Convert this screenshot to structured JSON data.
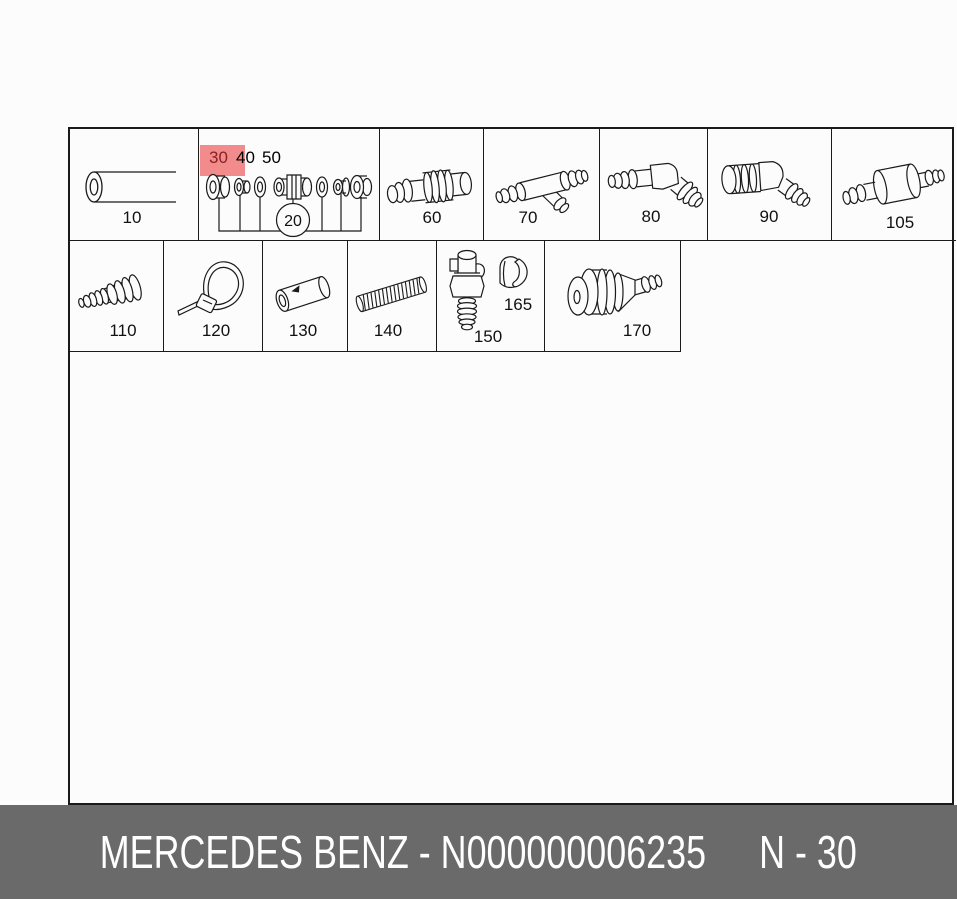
{
  "parts": {
    "p10": "10",
    "p20": "20",
    "p30": "30",
    "p40": "40",
    "p50": "50",
    "p60": "60",
    "p70": "70",
    "p80": "80",
    "p90": "90",
    "p105": "105",
    "p110": "110",
    "p120": "120",
    "p130": "130",
    "p140": "140",
    "p150": "150",
    "p165": "165",
    "p170": "170"
  },
  "highlight": {
    "part": "30",
    "bg_color": "#f28b8b",
    "text_color": "#8b2121"
  },
  "banner": {
    "text": "MERCEDES BENZ - N000000006235",
    "sheet": "N - 30",
    "bg_color": "#6a6a6a"
  },
  "colors": {
    "line": "#1a1a1a",
    "background": "#fcfcfc"
  }
}
